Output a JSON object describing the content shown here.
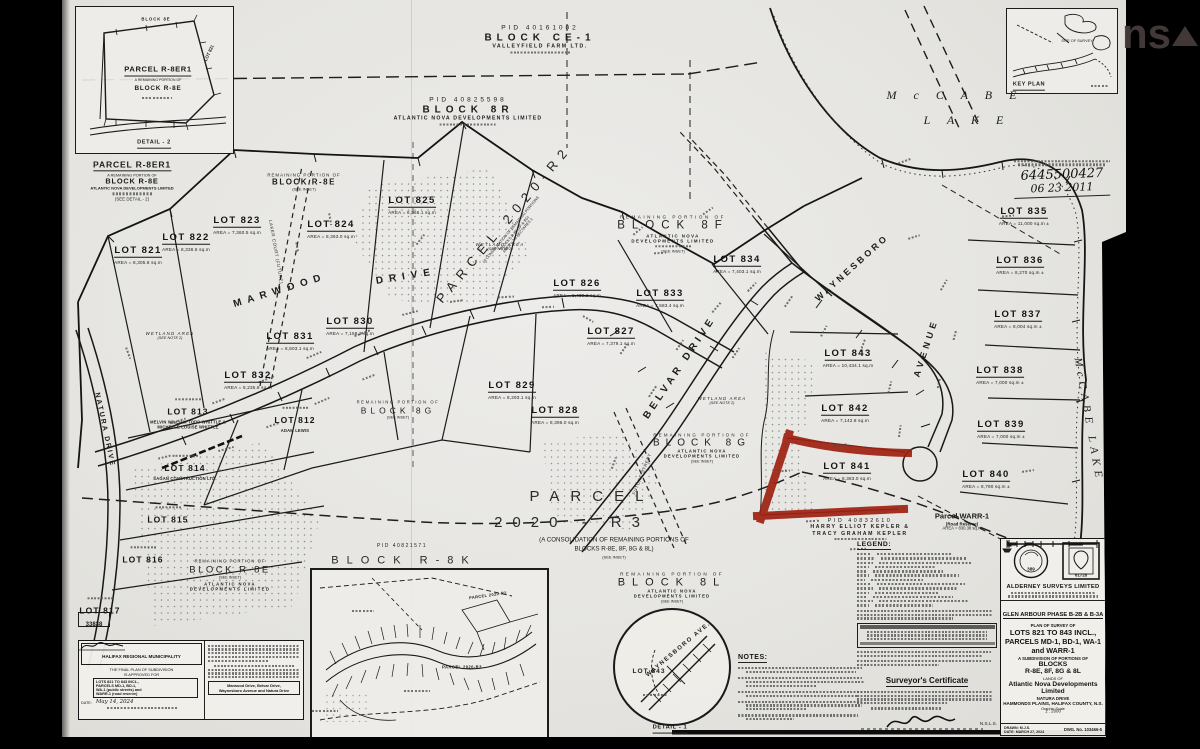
{
  "watermark": {
    "left": "ns",
    "right": "ar"
  },
  "top_labels": {
    "ce1": {
      "pid": "PID  40161002",
      "block": "BLOCK  CE-1",
      "owner": "VALLEYFIELD  FARM  LTD."
    },
    "r8": {
      "pid": "PID  40825598",
      "block": "BLOCK  8R",
      "owner": "ATLANTIC  NOVA  DEVELOPMENTS  LIMITED"
    }
  },
  "common": {
    "remaining": "REMAINING PORTION OF",
    "see_inset": "(SEE INSET)",
    "atlantic": "ATLANTIC  NOVA",
    "dev_ltd": "DEVELOPMENTS  LIMITED"
  },
  "detail2": {
    "block_8e": "BLOCK 8E",
    "lot_821": "LOT 821",
    "title": "PARCEL R-8ER1",
    "sub": "A REMAINING PORTION OF",
    "block": "BLOCK R-8E",
    "caption": "DETAIL - 2"
  },
  "parcel_r8er1": {
    "title": "PARCEL R-8ER1",
    "sub": "A REMAINING PORTION OF",
    "block": "BLOCK R-8E",
    "owner": "ATLANTIC NOVA DEVELOPMENTS LIMITED",
    "see": "(SEE DETAIL - 2)"
  },
  "remaining_r8e_top": {
    "block": "BLOCK R-8E"
  },
  "key_plan": {
    "caption": "KEY PLAN",
    "site": "SITE OF SURVEY"
  },
  "registration": {
    "number": "6445500427",
    "date": "06 23 2011"
  },
  "lake": {
    "name1": "M c C A B E",
    "name2": "L A K E",
    "side": "McCABE   LAKE"
  },
  "streets": {
    "marwood1": "MARWOOD",
    "marwood2": "DRIVE",
    "belvar": "BELVAR  DRIVE",
    "waynesboro": "WAYNESBORO",
    "avenue": "AVENUE",
    "natura": "NATURA  DRIVE",
    "laker": "LAKER COURT (FUTURE)",
    "future_street": "FUTURE STREET"
  },
  "parcels": {
    "p2020r2": {
      "name": "PARCEL  2020-R2",
      "sub1": "(A CONSOLIDATION OF REMAINING PORTIONS",
      "sub2": "BLOCKS R-8E, 8F & 8G)",
      "sub3": "AREA = 7.8 HECTARES ±"
    },
    "block8f": {
      "name": "BLOCK  8F"
    },
    "block8g": {
      "name": "BLOCK  8G"
    },
    "p2020r3": {
      "name1": "PARCEL",
      "name2": "2020 - R3",
      "sub1": "(A CONSOLIDATION OF REMAINING PORTIONS OF",
      "sub2": "BLOCKS R-8E, 8F, 8G & 8L)",
      "sub3": "(SEE INSET)"
    },
    "block8l": {
      "name": "BLOCK  8L"
    },
    "blockr8e_sw": {
      "name": "BLOCK R-8E"
    },
    "blockr8k": {
      "pid": "PID  40821571",
      "name": "BLOCK  R-8K"
    },
    "warr1": {
      "l1": "Parcel WARR-1",
      "l2": "(Road Reserve)",
      "l3": "AREA = 830.38 sq.m"
    },
    "kepler": {
      "pid": "PID  40832610",
      "l2": "HARRY  ELLIOT  KEPLER  &",
      "l3": "TRACY  GRAHAM  KEPLER"
    }
  },
  "wetland": {
    "l1": "WETLAND  AREA",
    "l2": "(SEE NOTE 2)"
  },
  "lots": [
    {
      "id": "LOT 821",
      "area": "AREA = 8,305.8 sq.m",
      "x": 76,
      "y": 252
    },
    {
      "id": "LOT 822",
      "area": "AREA = 8,336.5 sq.m",
      "x": 124,
      "y": 239
    },
    {
      "id": "LOT 823",
      "area": "AREA = 7,360.5 sq.m",
      "x": 175,
      "y": 222
    },
    {
      "id": "LOT 824",
      "area": "AREA = 8,363.0 sq.m",
      "x": 269,
      "y": 226
    },
    {
      "id": "LOT 825",
      "area": "AREA = 8,366.1 sq.m",
      "x": 350,
      "y": 202
    },
    {
      "id": "LOT 826",
      "area": "AREA = 8,439.3 sq.m",
      "x": 515,
      "y": 285
    },
    {
      "id": "LOT 827",
      "area": "AREA = 7,379.1 sq.m",
      "x": 549,
      "y": 333
    },
    {
      "id": "LOT 828",
      "area": "AREA = 8,396.0 sq.m",
      "x": 493,
      "y": 412
    },
    {
      "id": "LOT 829",
      "area": "AREA = 8,293.1 sq.m",
      "x": 450,
      "y": 387
    },
    {
      "id": "LOT 830",
      "area": "AREA = 7,158.3 sq.m",
      "x": 288,
      "y": 323
    },
    {
      "id": "LOT 831",
      "area": "AREA = 8,503.1 sq.m",
      "x": 228,
      "y": 338
    },
    {
      "id": "LOT 832",
      "area": "AREA = 8,235.8 sq.m",
      "x": 186,
      "y": 377
    },
    {
      "id": "LOT 833",
      "area": "AREA = 7,583.4 sq.m",
      "x": 598,
      "y": 295
    },
    {
      "id": "LOT 834",
      "area": "AREA = 7,403.1 sq.m",
      "x": 675,
      "y": 261
    },
    {
      "id": "LOT 835",
      "area": "AREA = 11,000 sq.m ±",
      "x": 962,
      "y": 213
    },
    {
      "id": "LOT 836",
      "area": "AREA = 8,270 sq.m ±",
      "x": 958,
      "y": 262
    },
    {
      "id": "LOT 837",
      "area": "AREA = 8,004 sq.m ±",
      "x": 956,
      "y": 316
    },
    {
      "id": "LOT 838",
      "area": "AREA = 7,000 sq.m ±",
      "x": 938,
      "y": 372
    },
    {
      "id": "LOT 839",
      "area": "AREA = 7,000 sq.m ±",
      "x": 939,
      "y": 426
    },
    {
      "id": "LOT 840",
      "area": "AREA = 8,790 sq.m ±",
      "x": 924,
      "y": 476
    },
    {
      "id": "LOT 841",
      "area": "AREA = 8,383.0 sq.m",
      "x": 785,
      "y": 468
    },
    {
      "id": "LOT 842",
      "area": "AREA = 7,142.8 sq.m",
      "x": 783,
      "y": 410
    },
    {
      "id": "LOT 843",
      "area": "AREA = 10,434.1 sq.m",
      "x": 786,
      "y": 355
    }
  ],
  "old_lots": [
    {
      "id": "LOT 812",
      "owners": [
        "ADAM  LEWIS"
      ],
      "x": 233,
      "y": 419
    },
    {
      "id": "LOT 813",
      "owners": [
        "MELVIN WILLIAM TODD WHITTLE &",
        "MICHELLE LOUISE WHITTLE"
      ],
      "x": 126,
      "y": 413
    },
    {
      "id": "LOT 814",
      "owners": [
        "SAGAN  CONSTRUCTION  LTD."
      ],
      "x": 123,
      "y": 467
    },
    {
      "id": "LOT 815",
      "owners": [],
      "x": 106,
      "y": 516
    },
    {
      "id": "LOT 816",
      "owners": [],
      "x": 81,
      "y": 556
    },
    {
      "id": "LOT 817",
      "owners": [],
      "x": 38,
      "y": 607
    }
  ],
  "detail1": {
    "street": "WAYNESBORO  AVE.",
    "lot": "LOT  843",
    "caption": "DETAIL - 1"
  },
  "inset_overview": {
    "p2": "PARCEL 2020-R2",
    "p3": "PARCEL 2020-R3"
  },
  "legend": {
    "title": "LEGEND:"
  },
  "notes": {
    "title": "NOTES:"
  },
  "certificate": {
    "title": "Surveyor's Certificate",
    "suffix": "N.S.L.S."
  },
  "hrm": {
    "ref": "33838",
    "title": "HALIFAX REGIONAL MUNICIPALITY",
    "l1": "THE FINAL PLAN OF SUBDIVISION",
    "l2": "IS APPROVED FOR",
    "box1": "LOTS 821 TO 843 INCL.,",
    "box2": "PARCELS MD-1, BD-1,",
    "box3": "WA-1 (public streets) and",
    "box4": "WARR-1 (road reserve)",
    "date_label": "DATE:",
    "date": "May 14, 2024",
    "streets1": "Marwood Drive, Belvar Drive,",
    "streets2": "Waynesboro Avenue and Natura Drive"
  },
  "titleblock": {
    "firm": "ALDERNEY  SURVEYS  LIMITED",
    "project": "GLEN ARBOUR PHASE B-2B & B-3A",
    "l1": "PLAN OF SURVEY OF",
    "l2": "LOTS 821 TO 843 INCL.,",
    "l3": "PARCELS MD-1, BD-1, WA-1",
    "l4": "and WARR-1",
    "l5": "A SUBDIVISION OF PORTIONS OF",
    "l6": "BLOCKS",
    "l7": "R-8E, 8F, 8G & 8L",
    "l8": "LANDS OF",
    "l9": "Atlantic Nova Developments",
    "l10": "Limited",
    "l11": "NATURA DRIVE",
    "l12": "HAMMONDS PLAINS, HALIFAX COUNTY, N.S.",
    "scale_label": "Graphic Scale",
    "scale": "1 : 2000",
    "drawn": "DRAWN: M.J.S.",
    "date": "DATE: MARCH 27, 2024",
    "dwg": "DWG. No. 103466-5",
    "seal_number": "389",
    "stamp_number": "61728"
  }
}
